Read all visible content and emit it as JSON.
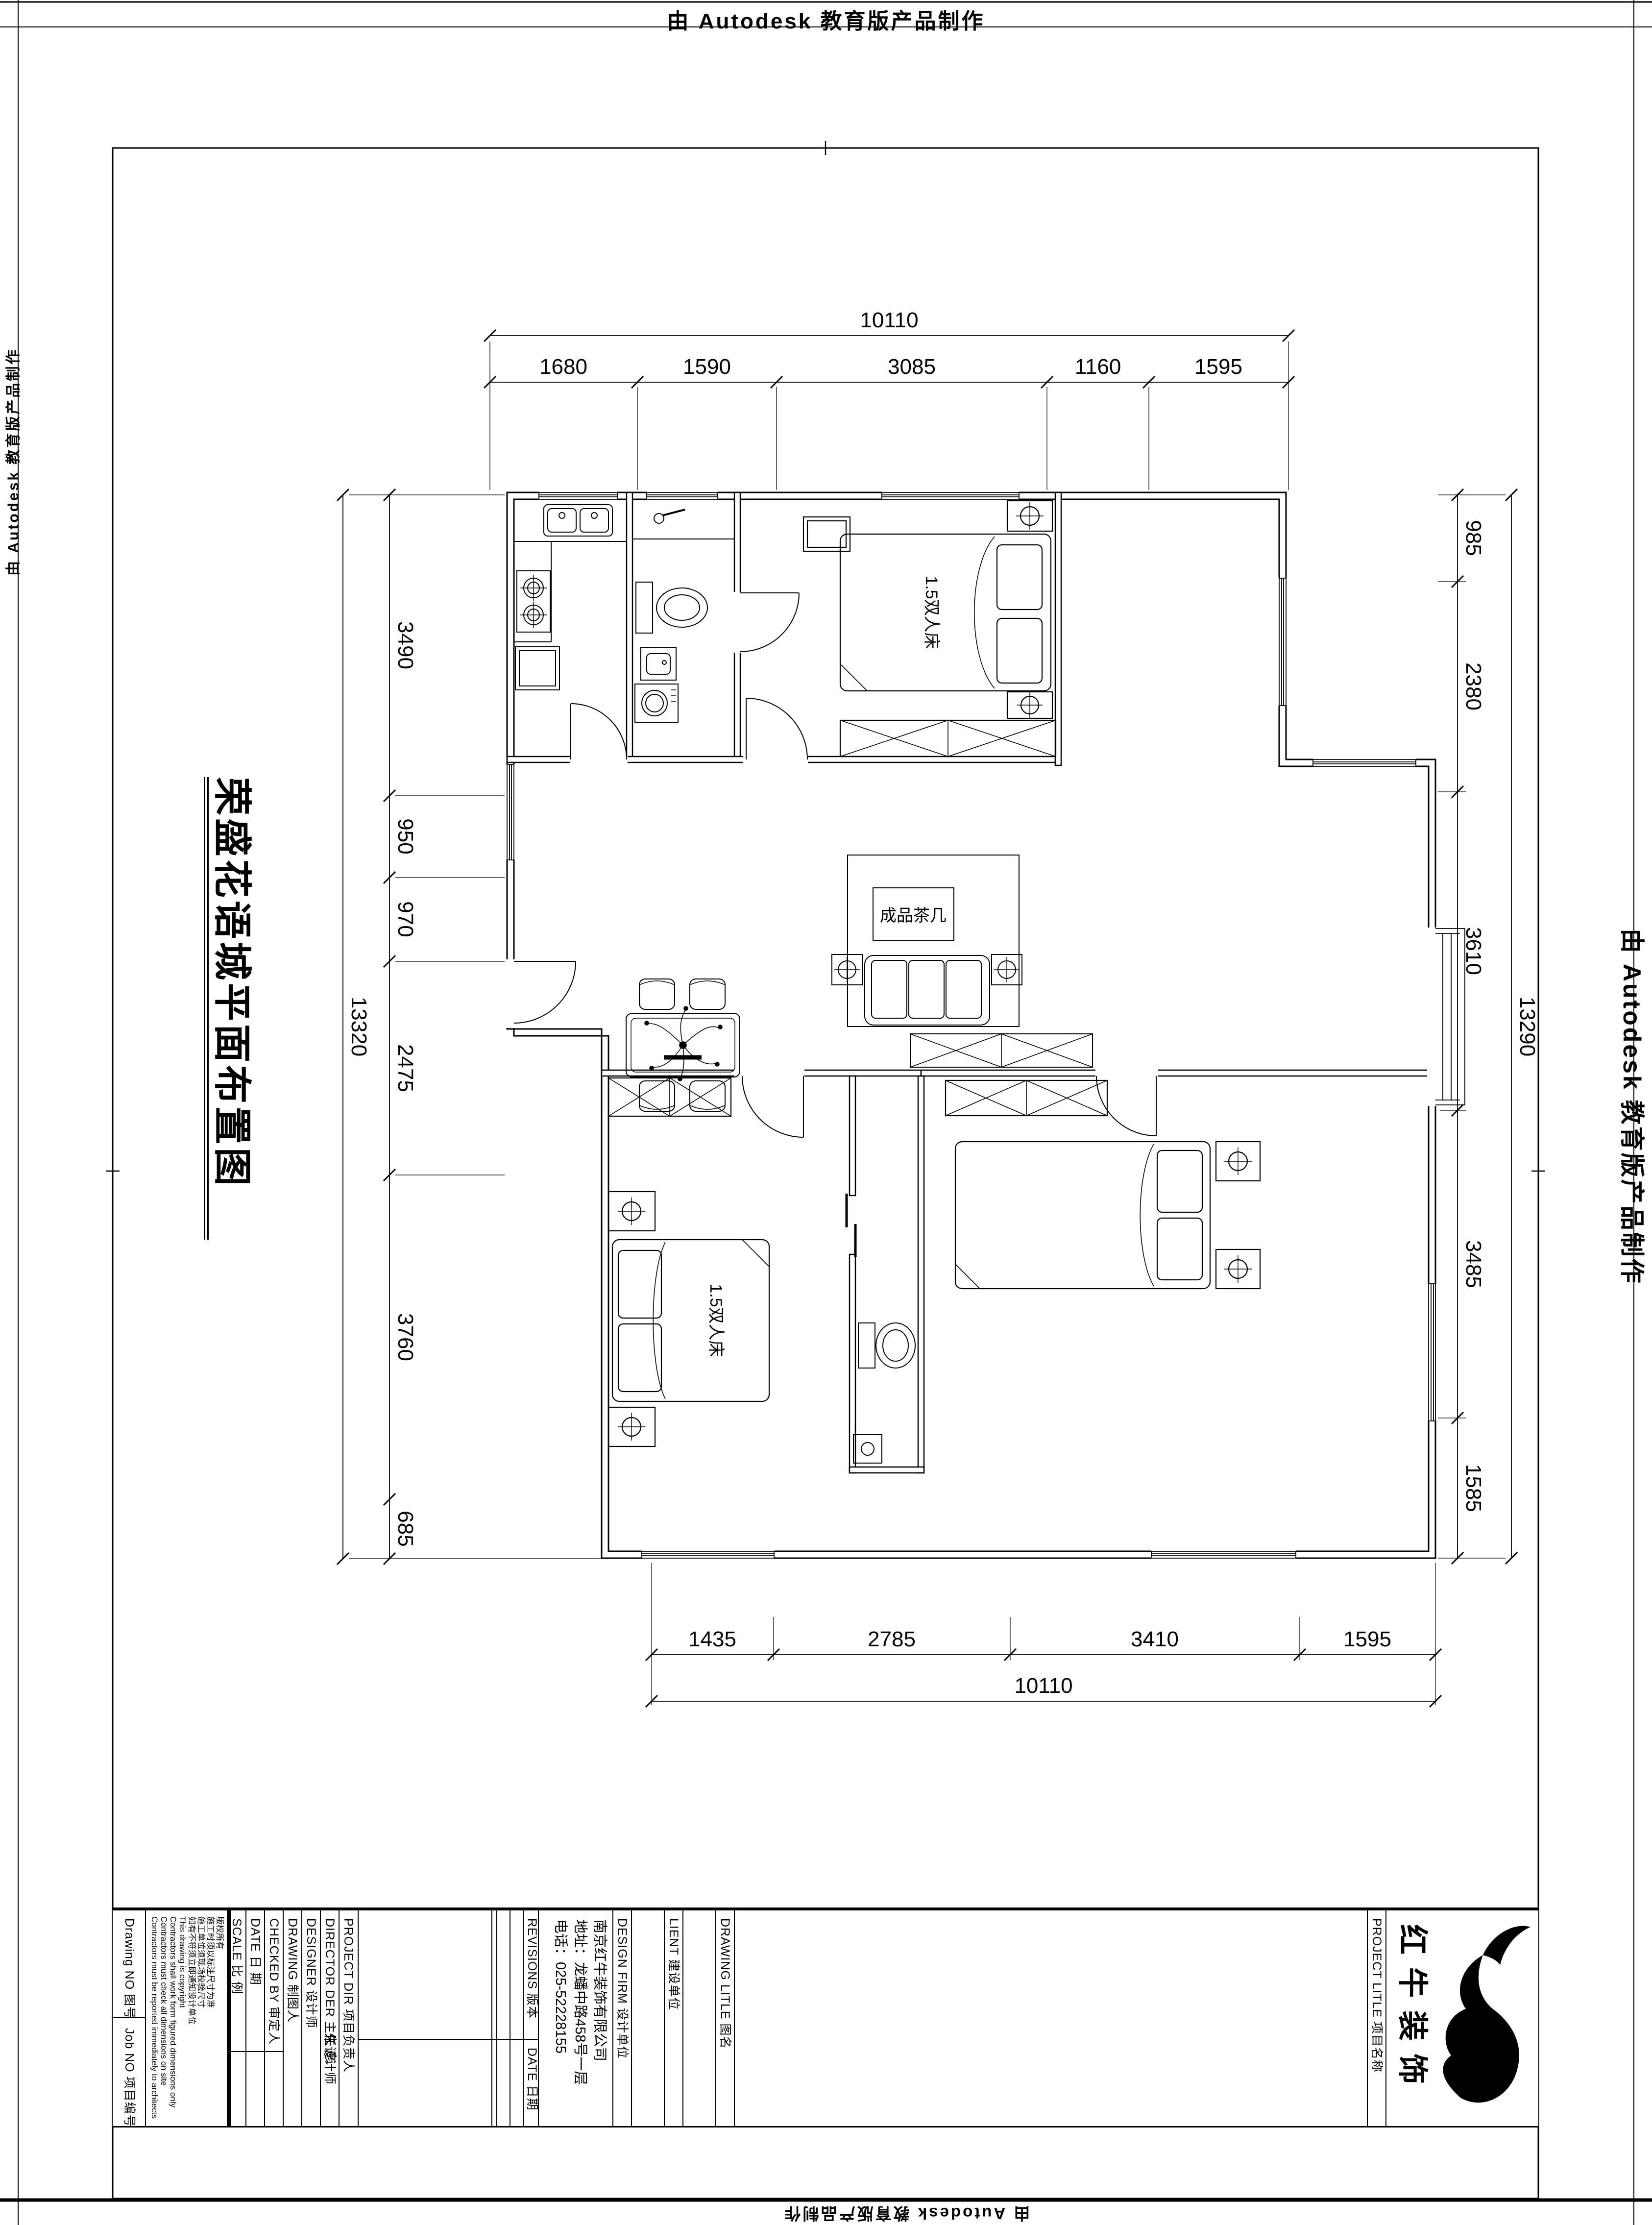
{
  "page": {
    "stamp_text": "由 Autodesk 教育版产品制作"
  },
  "sheet": {
    "title": "荣盛花语城平面布置图"
  },
  "plan": {
    "room_labels": {
      "master_bed": "1.5双人床",
      "second_bed": "1.5双人床",
      "coffee_table": "成品茶几"
    },
    "dimensions": {
      "top": {
        "total": "10110",
        "segments": [
          "1680",
          "1590",
          "3085",
          "1160",
          "1595"
        ]
      },
      "bottom": {
        "total": "10110",
        "segments": [
          "1435",
          "2785",
          "3410",
          "1595"
        ]
      },
      "left": {
        "total": "13320",
        "segments": [
          "3490",
          "950",
          "970",
          "2475",
          "3760",
          "685"
        ]
      },
      "right": {
        "total": "13290",
        "segments": [
          "985",
          "2380",
          "3610",
          "3485",
          "1585"
        ]
      }
    }
  },
  "title_block": {
    "drawing_no_label": "Drawing NO 图号",
    "job_no_label": "Job NO 项目编号",
    "copyright": [
      "版权所有",
      "施工时须以标注尺寸为准",
      "施工单位须现场校验尺寸",
      "如有不符须立即通知设计单位",
      "This drawing is copyright",
      "Contractors shall work form figured dimensions only",
      "Contractors must check all dimensions on site",
      "Contractors must be reported immediately to architects"
    ],
    "fields": [
      {
        "label": "SCALE  比  例"
      },
      {
        "label": "DATE  日  期"
      },
      {
        "label": "CHECKED BY  审定人"
      },
      {
        "label": "DRAWING  制图人"
      },
      {
        "label": "DESIGNER  设计师"
      },
      {
        "label": "DIRECTOR DER 主任设计师",
        "value": "朱  彦"
      },
      {
        "label": "PROJECT DIR  项目负责人"
      }
    ],
    "revisions_label": "REVISIONS  版本",
    "revisions_date_label": "DATE 日期",
    "design_firm_label": "DESIGN FIRM  设计单位",
    "design_firm_lines": [
      "南京红牛装饰有限公司",
      "地址：龙蟠中路458号一层",
      "电话：025-52228155"
    ],
    "client_label": "LIENT  建设单位",
    "drawing_title_label": "DRAWING LITLE  图名",
    "project_title_label": "PROJECT LITLE  项目名称",
    "logo_text": "红牛装饰"
  }
}
